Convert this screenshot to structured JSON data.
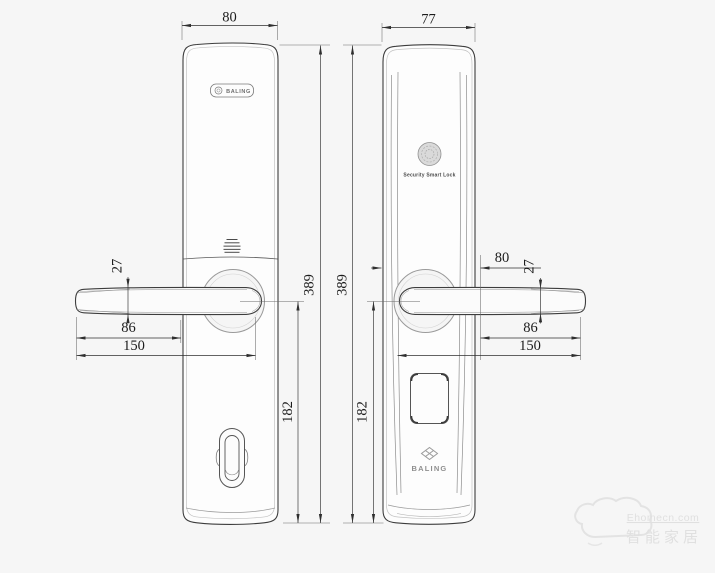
{
  "colors": {
    "background": "#f6f6f6",
    "outline": "#3d3d3d",
    "dimension_line": "#2f2f2f",
    "light_line": "#b5b5b5",
    "watermark": "#e0e0e0"
  },
  "front_view": {
    "brand_plate_text": "BALING",
    "width_dim": "80",
    "handle_height_dim": "27",
    "handle_to_body_dim": "86",
    "handle_length_dim": "150",
    "total_height_dim": "389",
    "lower_height_dim": "182"
  },
  "rear_view": {
    "width_dim": "77",
    "fingerprint_caption": "Security Smart Lock",
    "brand_text": "BALING",
    "body_span_dim": "80",
    "handle_height_dim": "27",
    "handle_to_body_dim": "86",
    "handle_length_dim": "150",
    "total_height_dim": "389",
    "lower_height_dim": "182"
  },
  "watermark": {
    "line1": "Ehomecn.com",
    "line2": "智能家居"
  }
}
